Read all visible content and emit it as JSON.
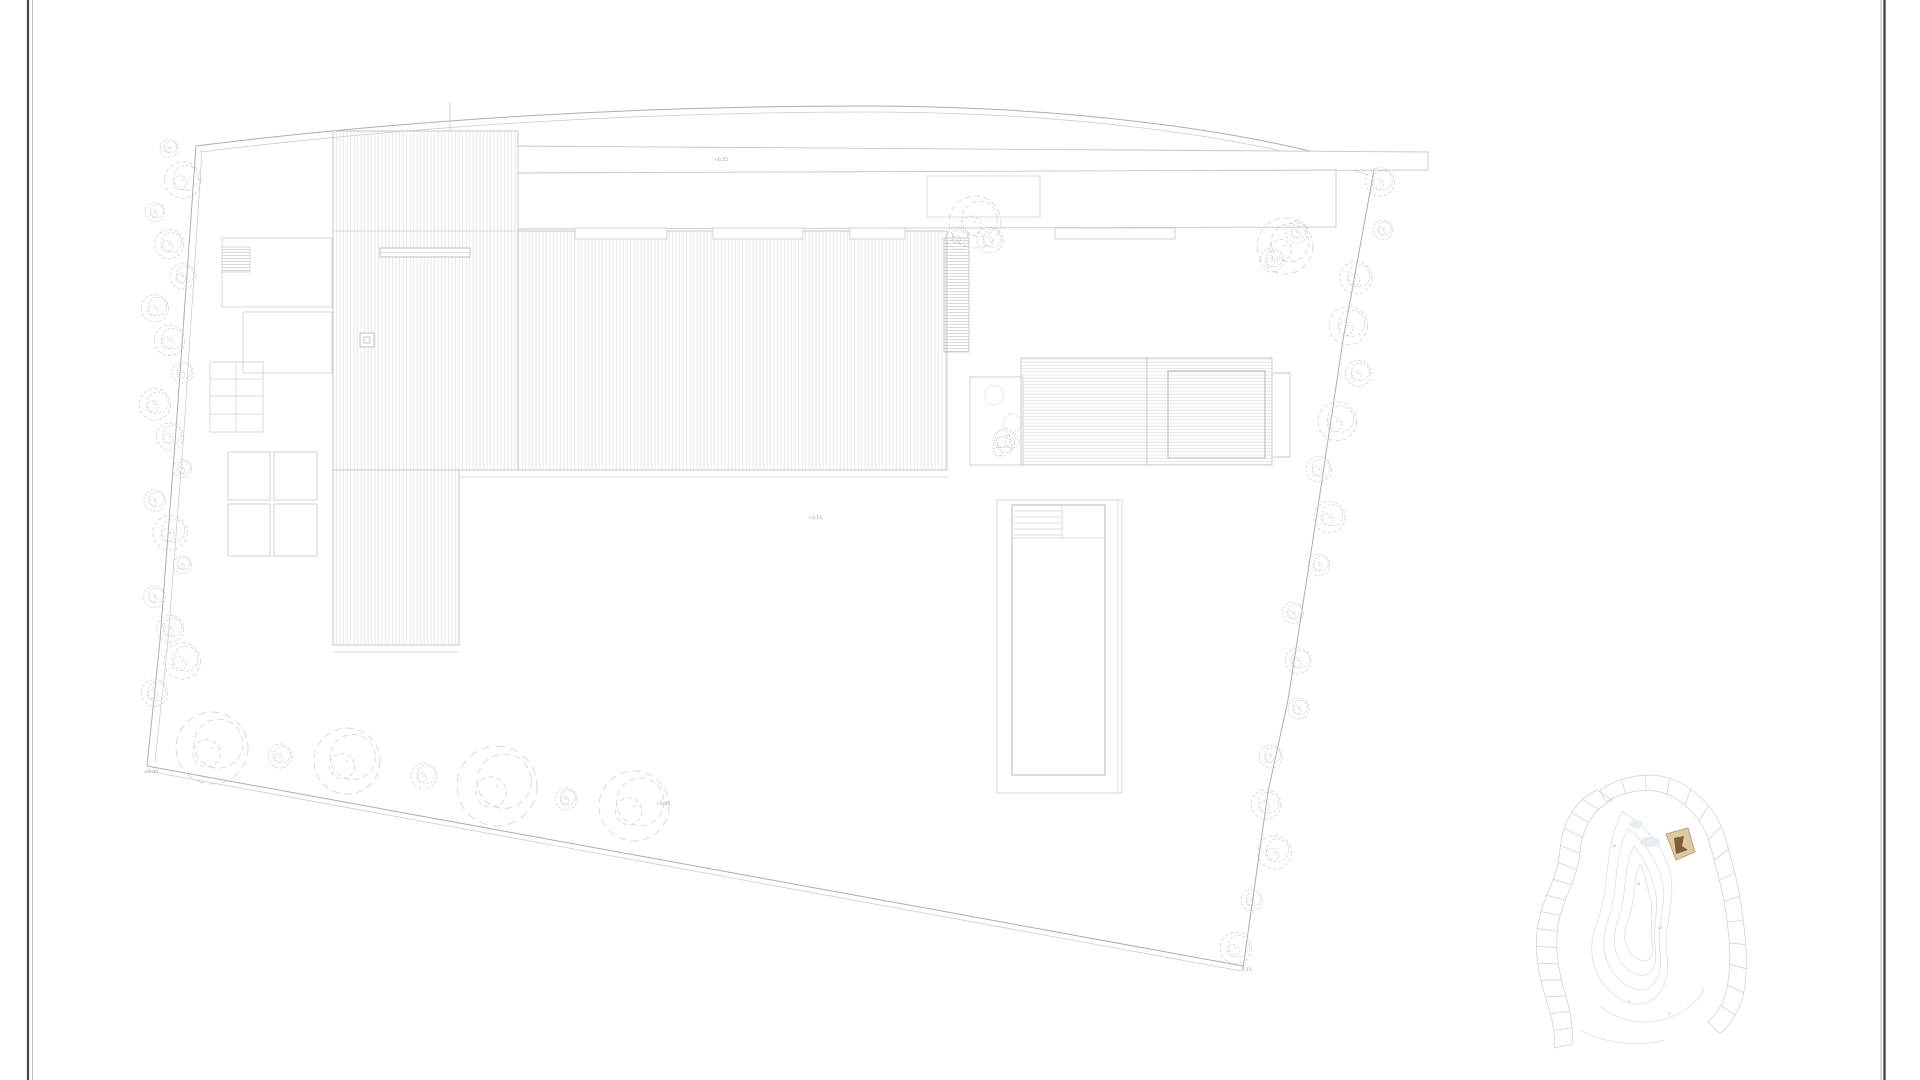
{
  "document": {
    "kind": "architectural-site-roof-plan",
    "sheet_background": "#ffffff"
  },
  "frame": {
    "dark_line": "#464646",
    "light_line": "#b8b8b8"
  },
  "plan": {
    "colors": {
      "outline": "#c3c7cb",
      "boundary": "#a8aeb4",
      "boundary_light": "#c9cdd1",
      "hatch": "#e3e5e7",
      "tree": "#c7cbd1",
      "label": "#989ea4"
    },
    "elevation_labels": [
      {
        "id": "canopy-roof",
        "text": "+6.55"
      },
      {
        "id": "east-terrace",
        "text": "+0.15"
      },
      {
        "id": "sw-ground",
        "text": "±0.00"
      },
      {
        "id": "garden-row",
        "text": "+0.45"
      },
      {
        "id": "se-boundary",
        "text": "-0.15"
      }
    ]
  },
  "inset_map": {
    "line": "#c9cdd1",
    "contour": "#d6dade",
    "highlight_fill": "#dcc9a2",
    "highlight_stroke": "#b3935f",
    "highlight_mark": "#7c5e37",
    "water": "#e6eef3",
    "lot_labels": [
      {
        "text": "24"
      },
      {
        "text": "18"
      },
      {
        "text": "11"
      },
      {
        "text": "7"
      },
      {
        "text": "3"
      }
    ]
  }
}
